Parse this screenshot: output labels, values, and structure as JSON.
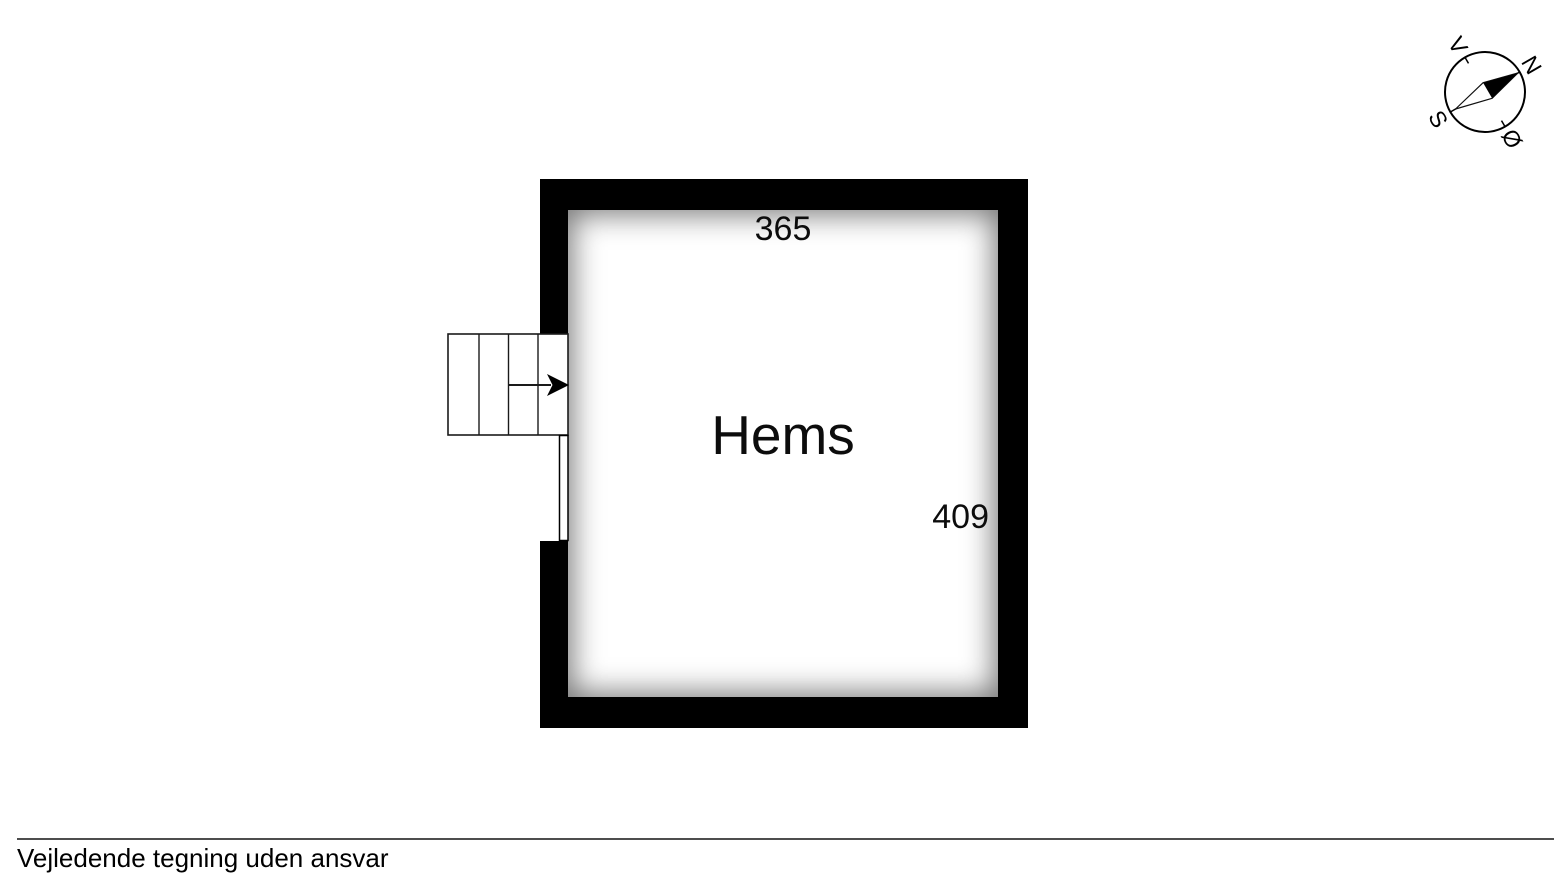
{
  "floorplan": {
    "room": {
      "label": "Hems",
      "top_dimension": "365",
      "right_dimension": "409"
    },
    "walls": {
      "color": "#000000"
    },
    "stairs": {
      "treads": 4,
      "direction": "right-into-room"
    }
  },
  "compass": {
    "rotation_deg": 60,
    "labels": {
      "north": "N",
      "east": "Ø",
      "south": "S",
      "west": "V"
    }
  },
  "footer": {
    "disclaimer": "Vejledende tegning uden ansvar",
    "rule_color": "#4d4d4d"
  }
}
